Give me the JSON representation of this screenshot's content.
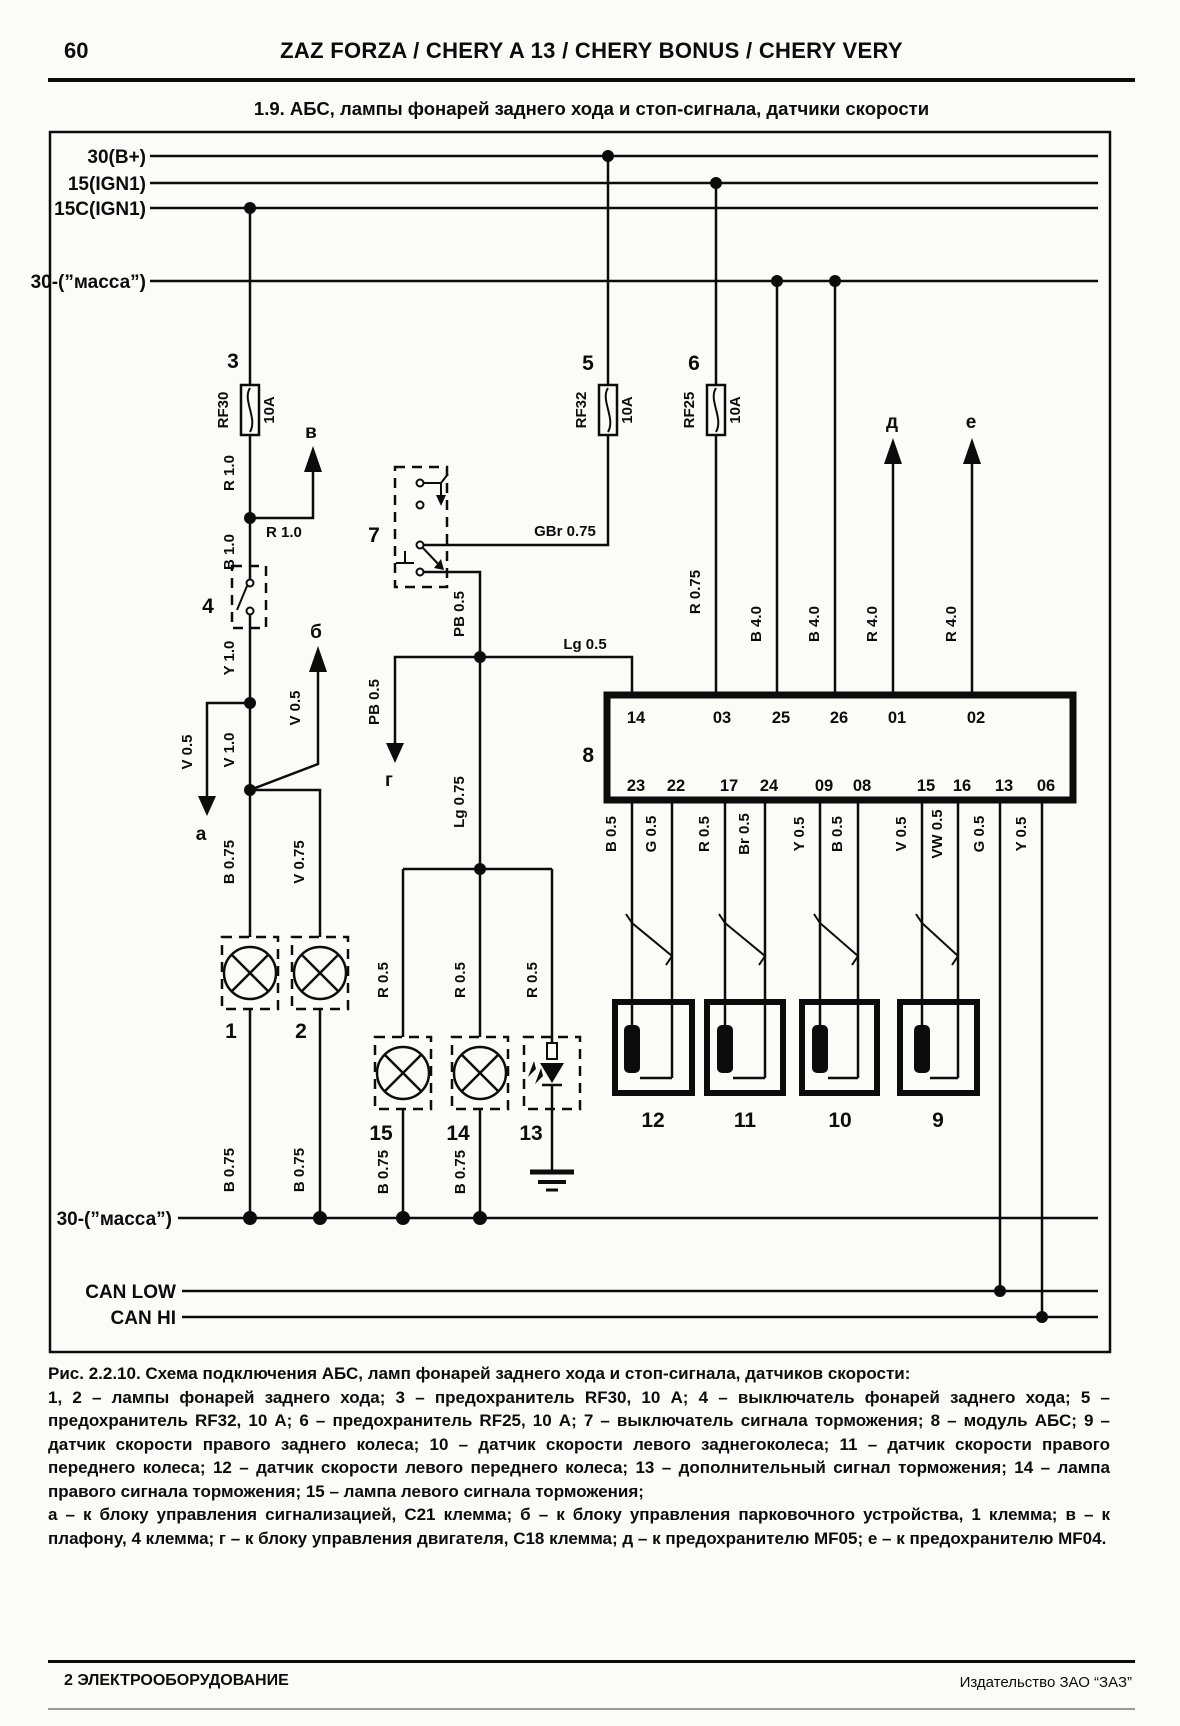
{
  "header": {
    "page_number": "60",
    "title": "ZAZ FORZA / CHERY A 13 / CHERY BONUS / CHERY VERY"
  },
  "section_title": "1.9. АБС, лампы фонарей заднего хода и стоп-сигнала, датчики скорости",
  "buses": {
    "b30": "30(B+)",
    "ign15": "15(IGN1)",
    "ign15c": "15C(IGN1)",
    "gnd_top": "30-(”масса”)",
    "gnd_bottom": "30-(”масса”)",
    "can_low": "CAN LOW",
    "can_hi": "CAN HI"
  },
  "fuses": [
    {
      "num": "3",
      "name": "RF30",
      "rating": "10A"
    },
    {
      "num": "5",
      "name": "RF32",
      "rating": "10A"
    },
    {
      "num": "6",
      "name": "RF25",
      "rating": "10A"
    }
  ],
  "module": {
    "num": "8",
    "pins_top": [
      "14",
      "03",
      "25",
      "26",
      "01",
      "02"
    ],
    "pins_bottom": [
      "23",
      "22",
      "17",
      "24",
      "09",
      "08",
      "15",
      "16",
      "13",
      "06"
    ]
  },
  "components": {
    "lamp1": "1",
    "lamp2": "2",
    "switch4": "4",
    "switch7": "7",
    "sensor9": "9",
    "sensor10": "10",
    "sensor11": "11",
    "sensor12": "12",
    "led13": "13",
    "lamp14": "14",
    "lamp15": "15"
  },
  "arrows": {
    "a": "а",
    "b": "б",
    "v": "в",
    "g": "г",
    "d": "д",
    "e": "е"
  },
  "wires": {
    "r10_v": "R 1.0",
    "r10_h": "R 1.0",
    "b10": "B 1.0",
    "y10": "Y 1.0",
    "v05_a": "V 0.5",
    "v10": "V 1.0",
    "v05_b": "V 0.5",
    "b075_l1": "B 0.75",
    "v075_l2": "V 0.75",
    "b075_l1b": "B 0.75",
    "b075_l2b": "B 0.75",
    "gbr075": "GBr 0.75",
    "pb05_v": "PB 0.5",
    "pb05_g": "PB 0.5",
    "lg05": "Lg 0.5",
    "lg075": "Lg 0.75",
    "r05_l15": "R 0.5",
    "r05_l14": "R 0.5",
    "r05_l13": "R 0.5",
    "b075_l15": "B 0.75",
    "b075_l14": "B 0.75",
    "r075": "R 0.75",
    "b40_25": "B 4.0",
    "b40_26": "B 4.0",
    "r40_01": "R 4.0",
    "r40_02": "R 4.0",
    "b05_23": "B 0.5",
    "g05_22": "G 0.5",
    "r05_17": "R 0.5",
    "br05_24": "Br 0.5",
    "y05_09": "Y 0.5",
    "b05_08": "B 0.5",
    "v05_15": "V 0.5",
    "vw05_16": "VW 0.5",
    "g05_13": "G 0.5",
    "y05_06": "Y 0.5"
  },
  "caption": {
    "title": "Рис. 2.2.10. Схема подключения АБС, ламп фонарей заднего хода и стоп-сигнала, датчиков скорости:",
    "legend_components": "1, 2 – лампы фонарей заднего хода; 3 – предохранитель RF30, 10 А; 4 – выключатель фонарей заднего хода; 5 – предохранитель RF32, 10 А; 6 – предохранитель RF25, 10 А; 7 – выключатель сигнала торможения; 8 – модуль АБС; 9 – датчик скорости правого заднего колеса; 10 – датчик скорости левого заднегоколеса; 11 – датчик скорости правого переднего колеса; 12 – датчик скорости левого переднего колеса; 13 – дополнительный сигнал торможения; 14 – лампа правого сигнала торможения; 15 – лампа левого сигнала торможения;",
    "legend_letters": "а – к блоку управления сигнализацией, С21 клемма; б – к блоку управления парковочного устройства, 1 клемма; в – к плафону, 4 клемма; г – к блоку управления двигателя, С18 клемма; д – к предохранителю MF05; е – к предохранителю MF04."
  },
  "footer": {
    "left": "2 ЭЛЕКТРООБОРУДОВАНИЕ",
    "right": "Издательство ЗАО “ЗАЗ”"
  }
}
